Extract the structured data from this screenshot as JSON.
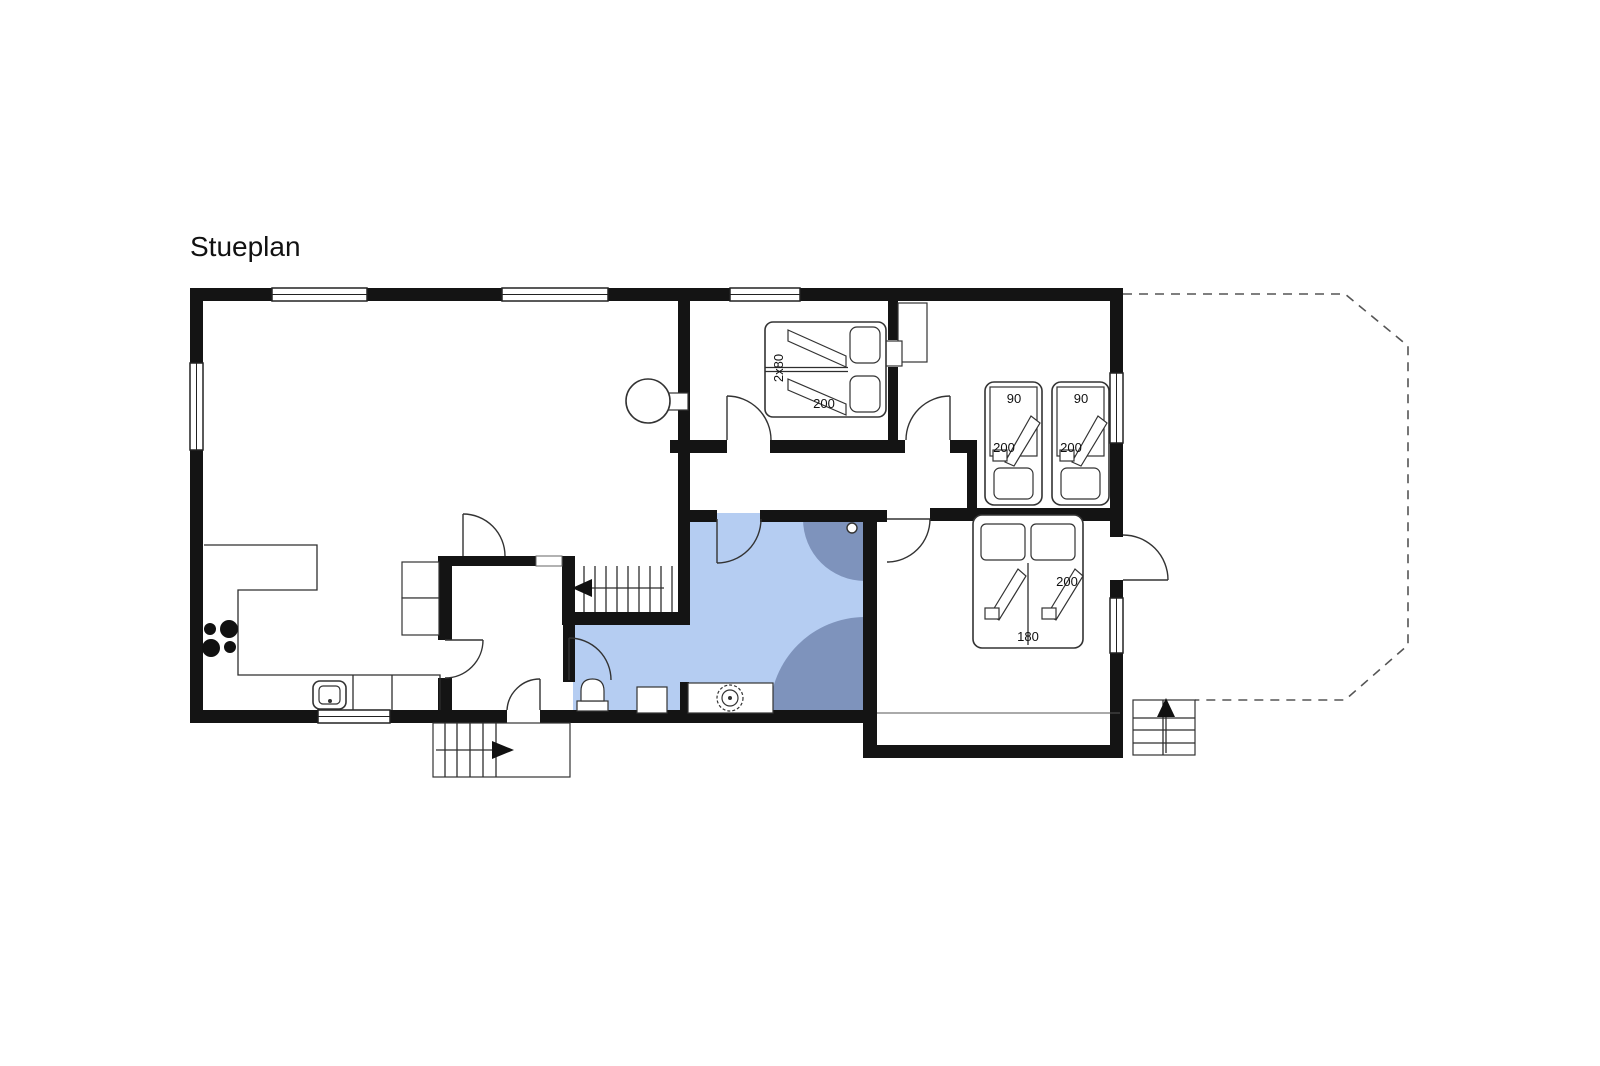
{
  "title": "Stueplan",
  "colors": {
    "wall": "#141414",
    "line": "#2e2e2e",
    "bath_light": "#b5cdf2",
    "bath_dark": "#7e93bc"
  },
  "plan": {
    "beds": {
      "bed_2x80": {
        "width_label": "2x80",
        "length_label": "200"
      },
      "single_left": {
        "width_label": "90",
        "length_label": "200"
      },
      "single_right": {
        "width_label": "90",
        "length_label": "200"
      },
      "double_180": {
        "width_label": "180",
        "length_label": "200"
      }
    }
  }
}
